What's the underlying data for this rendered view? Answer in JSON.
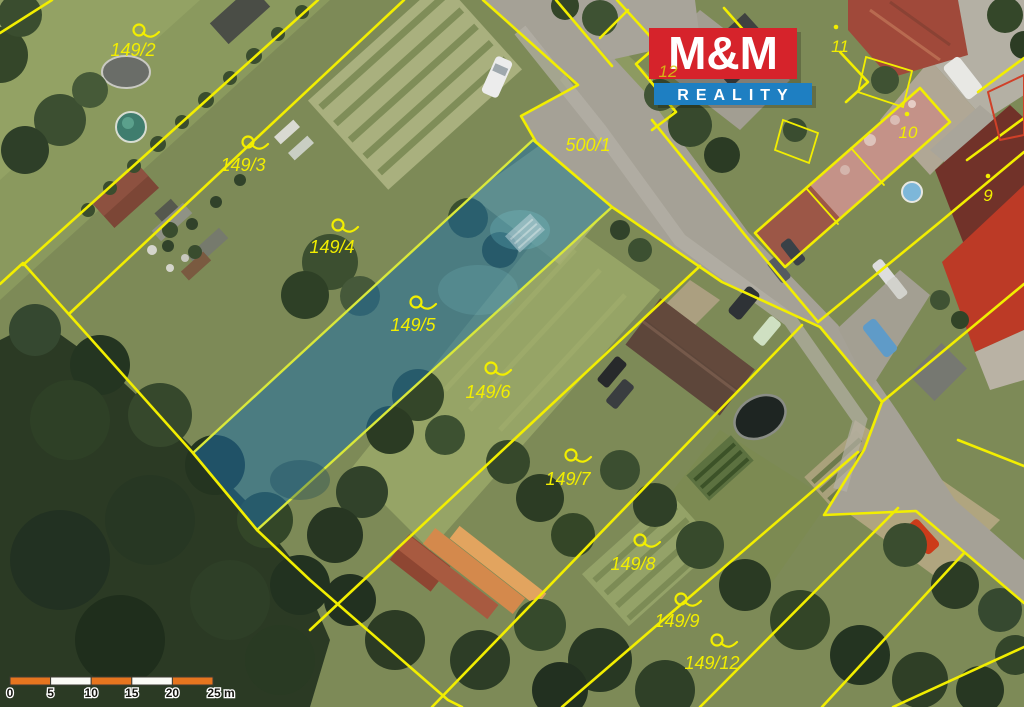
{
  "map_overlay": {
    "highlighted_parcel": "149/5",
    "line_color": "#f2ee00",
    "highlight_fill": "#2277b3",
    "highlight_stroke": "#d9e83a",
    "parcel_labels": [
      {
        "text": "149/2",
        "icon_x": 139,
        "icon_y": 30,
        "x": 133,
        "y": 56
      },
      {
        "text": "149/3",
        "icon_x": 248,
        "icon_y": 142,
        "x": 243,
        "y": 171
      },
      {
        "text": "149/4",
        "icon_x": 338,
        "icon_y": 225,
        "x": 332,
        "y": 253
      },
      {
        "text": "149/5",
        "icon_x": 416,
        "icon_y": 302,
        "x": 413,
        "y": 331
      },
      {
        "text": "149/6",
        "icon_x": 491,
        "icon_y": 368,
        "x": 488,
        "y": 398
      },
      {
        "text": "149/7",
        "icon_x": 571,
        "icon_y": 455,
        "x": 568,
        "y": 485
      },
      {
        "text": "149/8",
        "icon_x": 640,
        "icon_y": 540,
        "x": 633,
        "y": 570
      },
      {
        "text": "149/9",
        "icon_x": 681,
        "icon_y": 599,
        "x": 677,
        "y": 627
      },
      {
        "text": "149/12",
        "icon_x": 717,
        "icon_y": 640,
        "x": 712,
        "y": 669
      }
    ],
    "road_label": {
      "text": "500/1",
      "x": 588,
      "y": 151
    },
    "covered_label": {
      "text": "12",
      "x": 668,
      "y": 77
    },
    "building_labels": [
      {
        "text": "11",
        "dot_x": 836,
        "dot_y": 27,
        "x": 840,
        "y": 52
      },
      {
        "text": "10",
        "dot_x": 907,
        "dot_y": 114,
        "x": 908,
        "y": 138
      },
      {
        "text": "9",
        "dot_x": 988,
        "dot_y": 176,
        "x": 988,
        "y": 201
      }
    ]
  },
  "logo": {
    "top": "M&M",
    "bottom": "REALITY",
    "red": "#d6232b",
    "blue": "#1e7fc2"
  },
  "scale_bar": {
    "tick_labels": [
      "0",
      "5",
      "10",
      "15",
      "20",
      "25 m"
    ],
    "segment_colors": [
      "#e6751f",
      "#fbfbf6",
      "#e6751f",
      "#fbfbf6",
      "#e6751f"
    ]
  }
}
